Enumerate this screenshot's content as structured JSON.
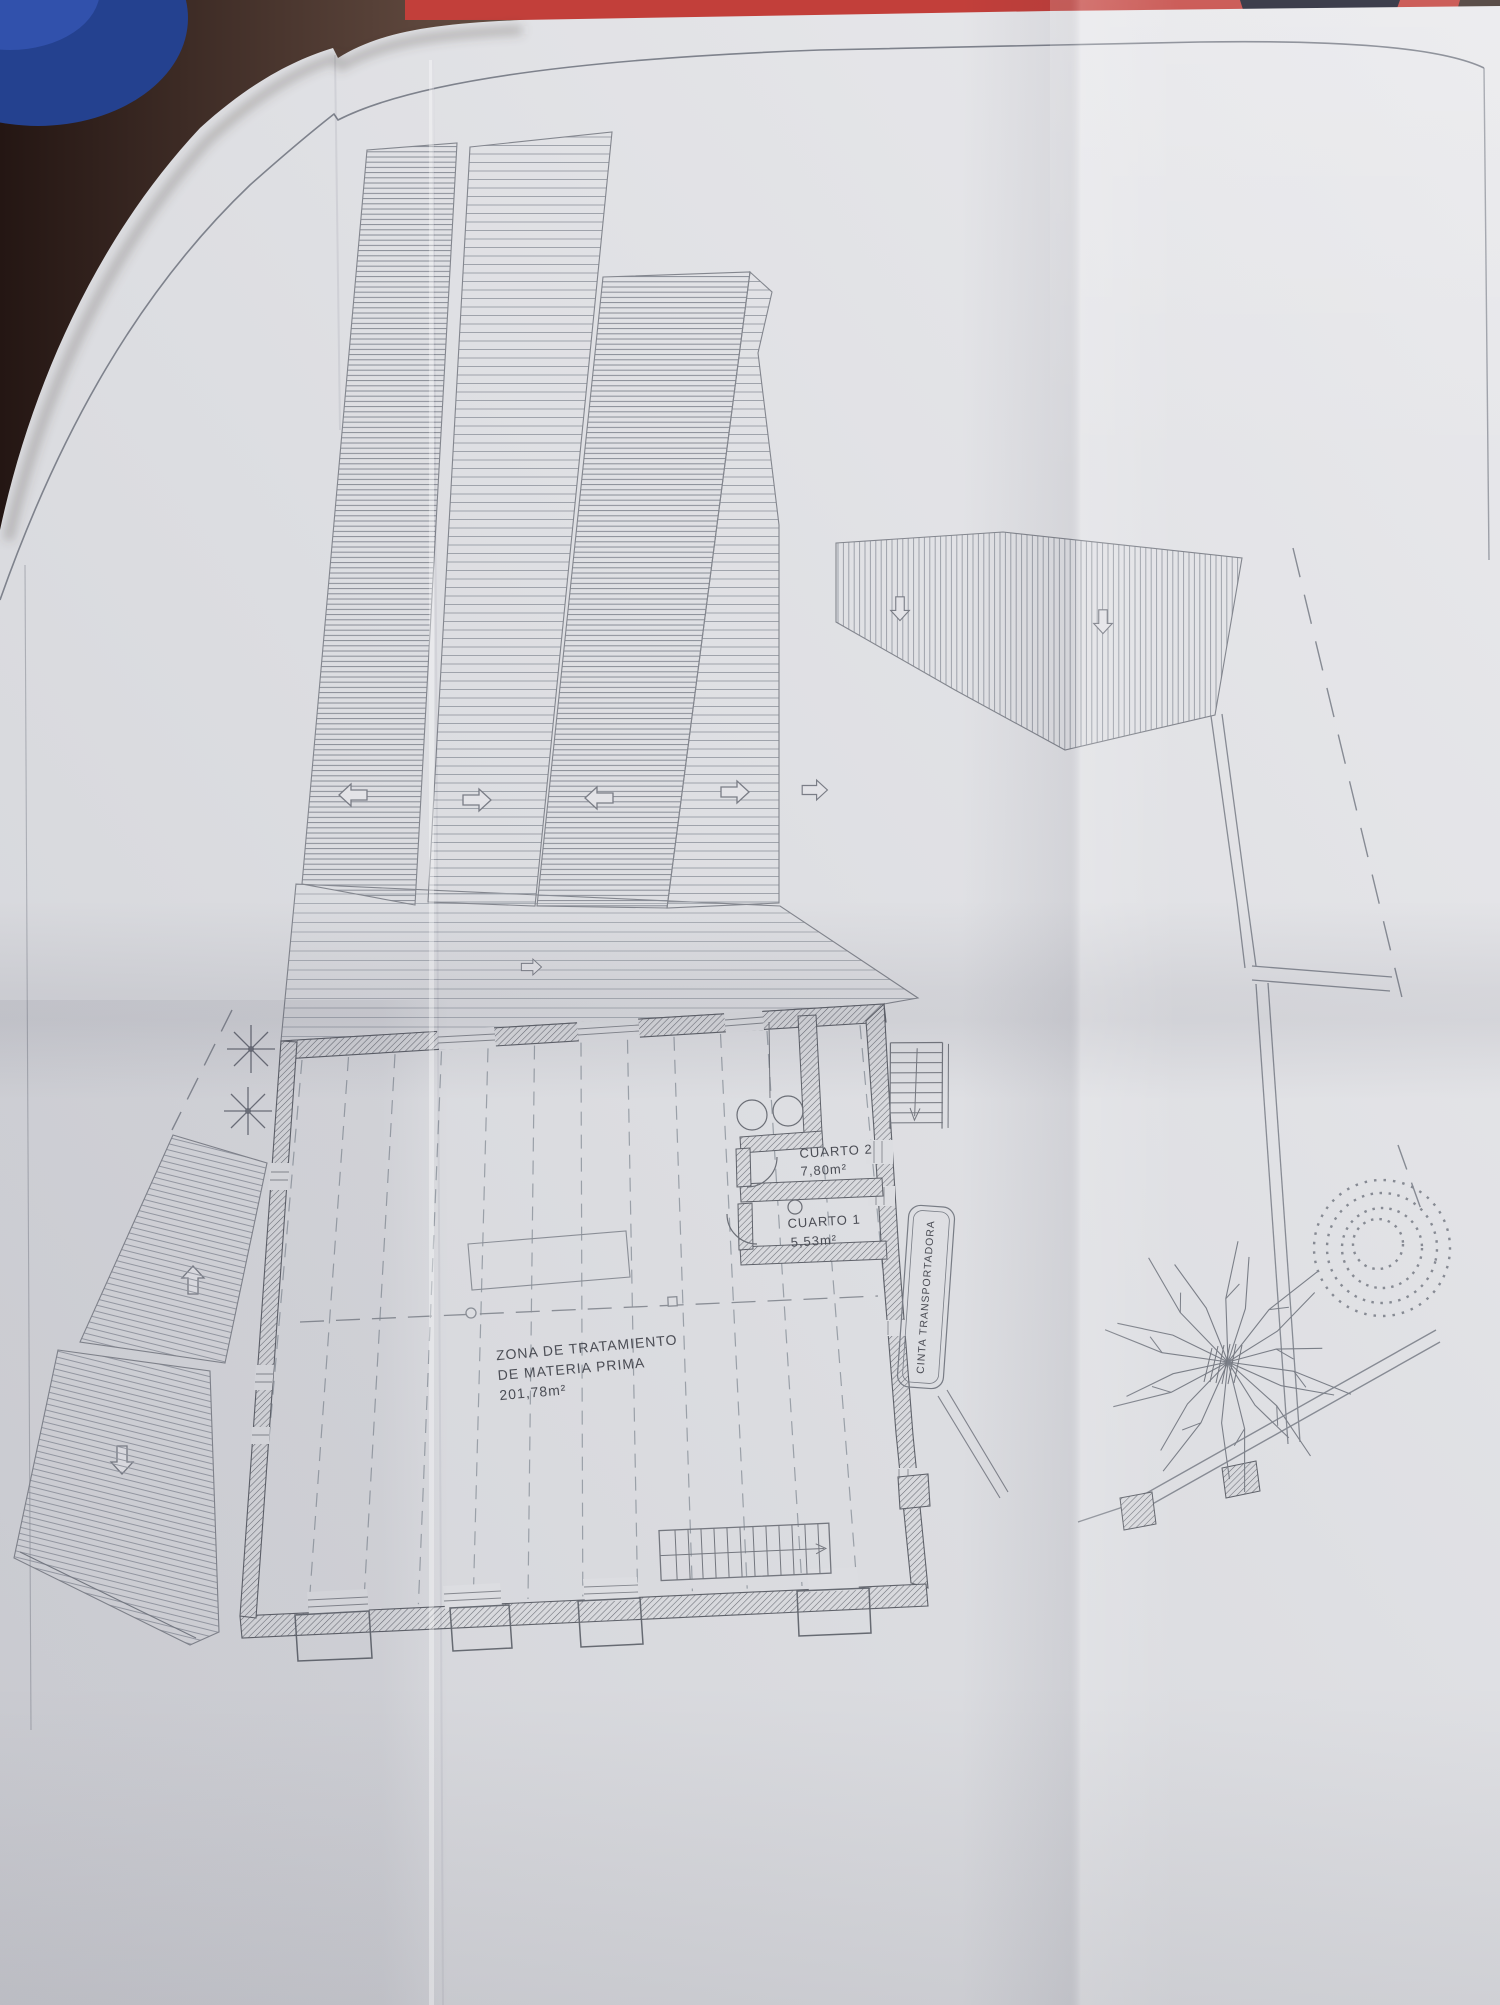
{
  "plan": {
    "treatment_zone": {
      "label_line1": "ZONA DE TRATAMIENTO",
      "label_line2": "DE MATERIA PRIMA",
      "area": "201,78m²"
    },
    "cuarto2": {
      "name": "CUARTO 2",
      "area": "7,80m²"
    },
    "cuarto1": {
      "name": "CUARTO 1",
      "area": "5,53m²"
    },
    "conveyor": {
      "label": "CINTA TRANSPORTADORA"
    }
  },
  "photo": {
    "table_color": "#54423a",
    "paper_color": "#dddde1",
    "ink_color": "#6e717a",
    "blue_object_color": "#24418f",
    "red_object_color": "#c23f3a"
  }
}
